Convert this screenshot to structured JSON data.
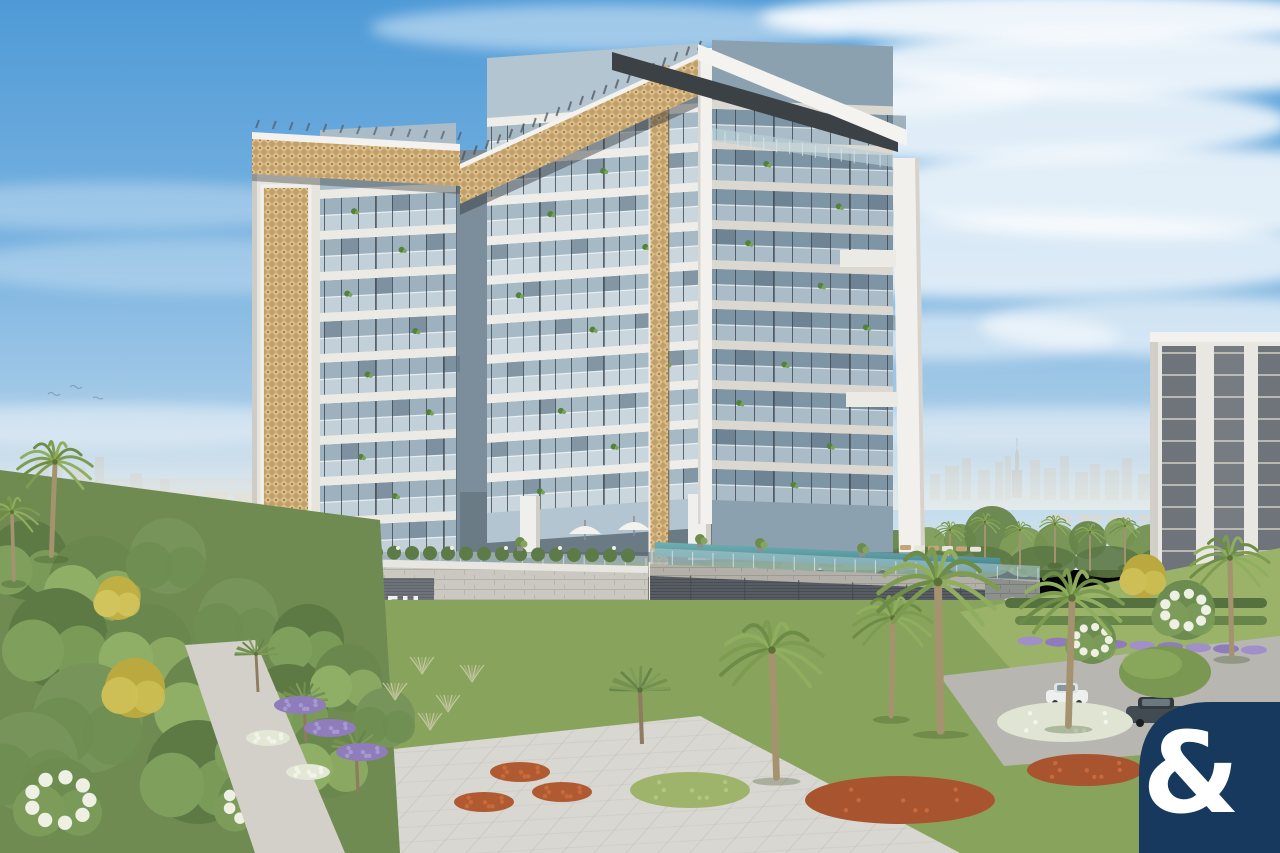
{
  "branding": {
    "sign": {
      "label": "ELLINGTON",
      "icon": "ellington-diamond-icon",
      "text_color": "#e9d9b4"
    },
    "plaque": {
      "label": "ELLINGTON HOUSE",
      "icon": "eh-monogram-icon",
      "text_color": "#d3d7d9"
    },
    "emblem": {
      "icon": "circle-diamond-emblem-icon",
      "ring_color": "#ece9e3"
    },
    "watermark": {
      "symbol": "&",
      "background": "#17395e",
      "symbol_color": "#ffffff"
    }
  },
  "palette": {
    "sky_top": "#4e9ad7",
    "sky_horizon": "#d9e8f1",
    "gold_screen": "#c7a26b",
    "facade_white": "#f1efeb",
    "glass_blue": "#9fb4c2",
    "stone_podium": "#c9c6bf",
    "dark_fascia": "#565c62",
    "foliage_dark": "#5d7a45",
    "foliage_light": "#8fae66",
    "lawn": "#93ad62",
    "lavender": "#9b87c2",
    "paving": "#d9d7d2",
    "pool": "#4b8a94"
  }
}
